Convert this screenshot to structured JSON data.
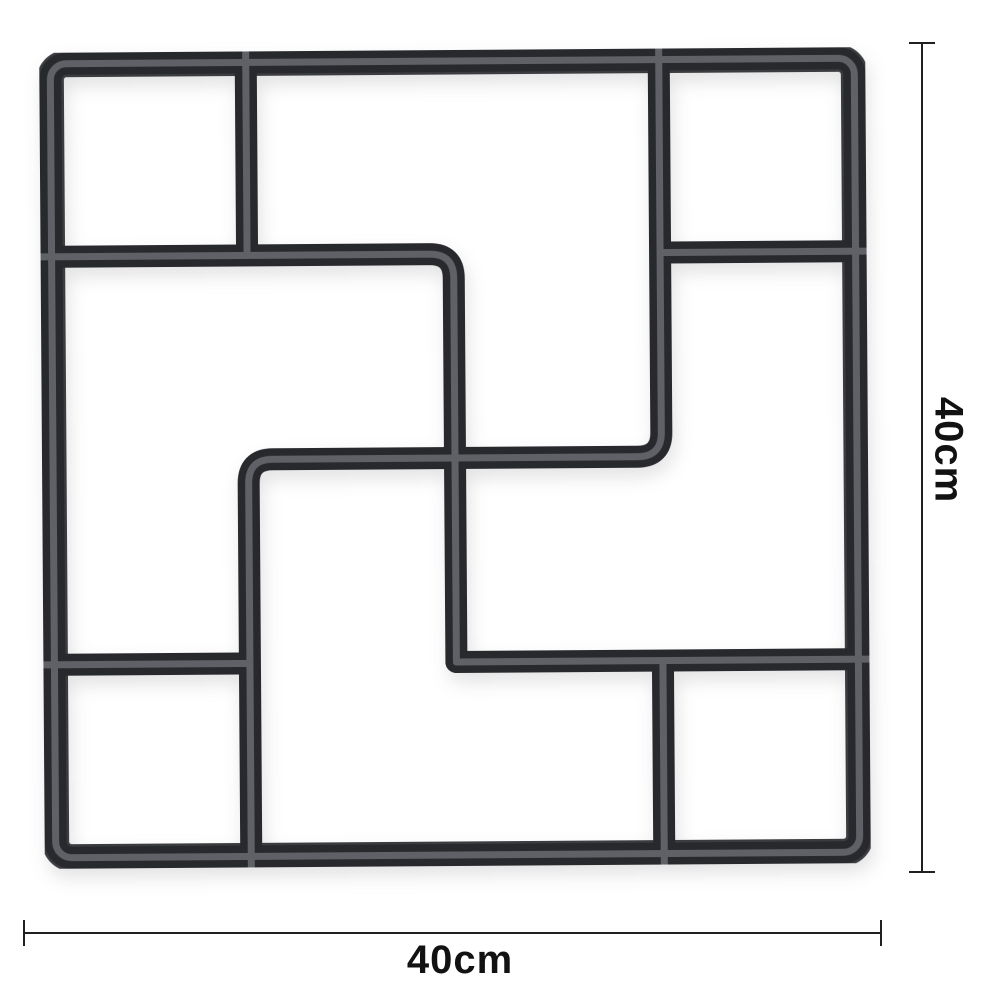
{
  "background_color": "#ffffff",
  "mold": {
    "name": "square-paving-mold",
    "colors": {
      "dark": "#28292d",
      "rim": "#3b3c40",
      "trough": "#5f6166"
    },
    "grid_units": 4,
    "frame_corner_radius": 16,
    "wall_thickness": 22,
    "corner_fillet": 24,
    "wall_segments_pct": [
      {
        "name": "top-left-divider",
        "points": [
          [
            25,
            0
          ],
          [
            25,
            25
          ]
        ]
      },
      {
        "name": "left-step-divider",
        "points": [
          [
            0,
            25
          ],
          [
            50,
            25
          ],
          [
            50,
            75
          ]
        ]
      },
      {
        "name": "center-zigzag-divider",
        "points": [
          [
            25,
            100
          ],
          [
            25,
            50
          ],
          [
            75,
            50
          ],
          [
            75,
            0
          ]
        ]
      },
      {
        "name": "bottom-right-shelf",
        "points": [
          [
            50,
            75
          ],
          [
            100,
            75
          ]
        ]
      },
      {
        "name": "bottom-left-shelf",
        "points": [
          [
            0,
            75
          ],
          [
            25,
            75
          ]
        ]
      },
      {
        "name": "top-right-shelf",
        "points": [
          [
            75,
            25
          ],
          [
            100,
            25
          ]
        ]
      },
      {
        "name": "bottom-right-divider",
        "points": [
          [
            75,
            75
          ],
          [
            75,
            100
          ]
        ]
      }
    ]
  },
  "dimensions": {
    "line_color": "#202020",
    "text_color": "#121212",
    "height": {
      "label": "40cm",
      "orientation": "vertical"
    },
    "width": {
      "label": "40cm",
      "orientation": "horizontal"
    }
  }
}
